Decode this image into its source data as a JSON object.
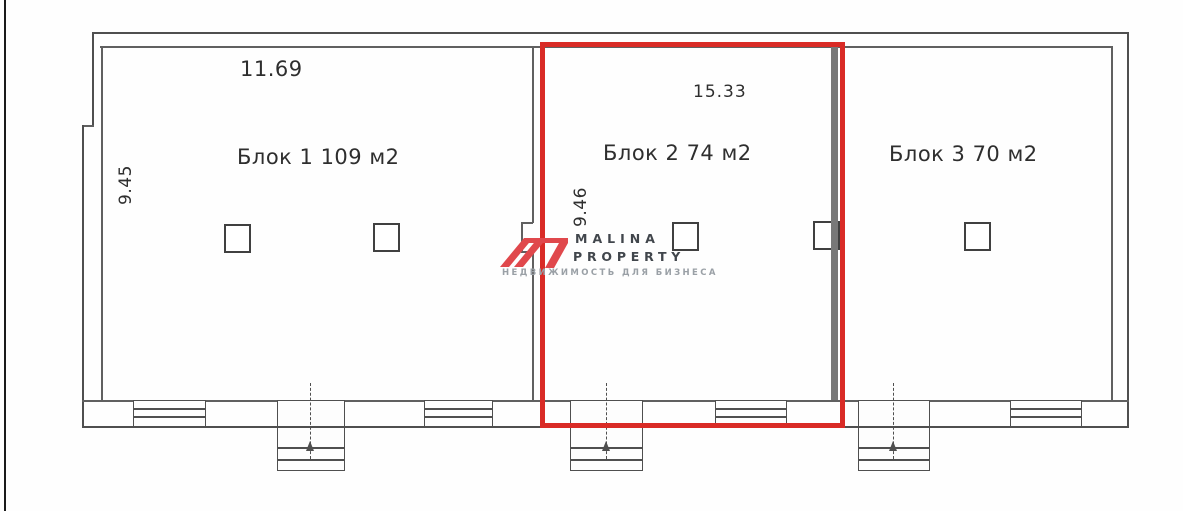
{
  "plan": {
    "blocks": [
      {
        "id": 1,
        "label": "Блок 1 109 м2",
        "top_dimension": "11.69",
        "side_dimension": "9.45"
      },
      {
        "id": 2,
        "label": "Блок 2 74 м2",
        "top_dimension": "15.33",
        "side_dimension": "9.46",
        "highlighted": true
      },
      {
        "id": 3,
        "label": "Блок 3 70 м2"
      }
    ]
  },
  "watermark": {
    "brand_line1": "MALINA",
    "brand_line2": "PROPERTY",
    "tagline": "НЕДВИЖИМОСТЬ ДЛЯ БИЗНЕСА"
  },
  "colors": {
    "highlight_red": "#d92b26",
    "logo_red": "#e0484c",
    "wall_gray": "#4f4f4f",
    "thin_gray": "#606060",
    "partition_gray": "#787878",
    "text_dark": "#2e2e2e",
    "brand_dark": "#41464c",
    "brand_light": "#9aa0a6"
  }
}
